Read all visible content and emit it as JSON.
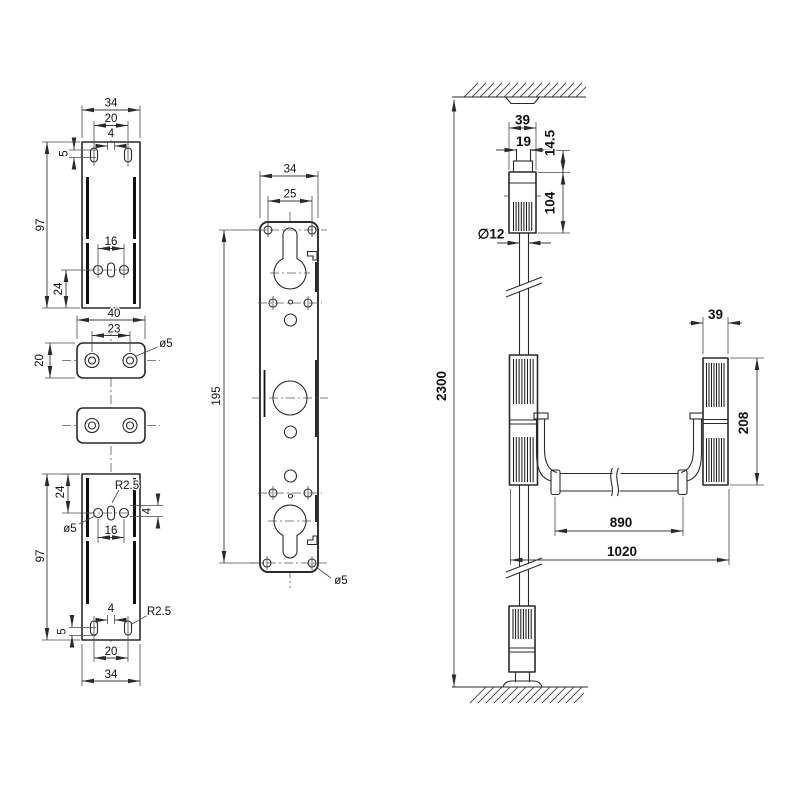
{
  "colors": {
    "background": "#ffffff",
    "line": "#2a2a2a"
  },
  "views": {
    "bracket_top": {
      "dims": {
        "width": "34",
        "hole_span": "20",
        "slot_width": "4",
        "edge_offset": "5",
        "height": "97",
        "hole_offset": "24",
        "hole_pitch": "16"
      }
    },
    "spacer_plates": {
      "dims": {
        "width": "40",
        "hole_pitch": "23",
        "height": "20",
        "hole_dia": "ø5"
      }
    },
    "bracket_bottom": {
      "dims": {
        "hole_offset": "24",
        "slot_radius_top": "R2.5",
        "hole_dia": "ø5",
        "hole_pitch": "16",
        "slot_height": "4",
        "height": "97",
        "slot_width": "4",
        "slot_radius_bottom": "R2.5",
        "edge_offset": "5",
        "slot_span": "20",
        "width": "34"
      }
    },
    "lock_plate": {
      "dims": {
        "width": "34",
        "hole_span": "25",
        "hole_spacing_v": "195",
        "hole_dia": "ø5"
      }
    },
    "assembly": {
      "dims": {
        "housing_width": "39",
        "latch_width": "19",
        "latch_offset": "14.5",
        "housing_length": "104",
        "rod_dia": "∅12",
        "total_height": "2300",
        "side_housing_width": "39",
        "side_housing_length": "208",
        "bar_length": "890",
        "overall_width": "1020"
      }
    }
  }
}
